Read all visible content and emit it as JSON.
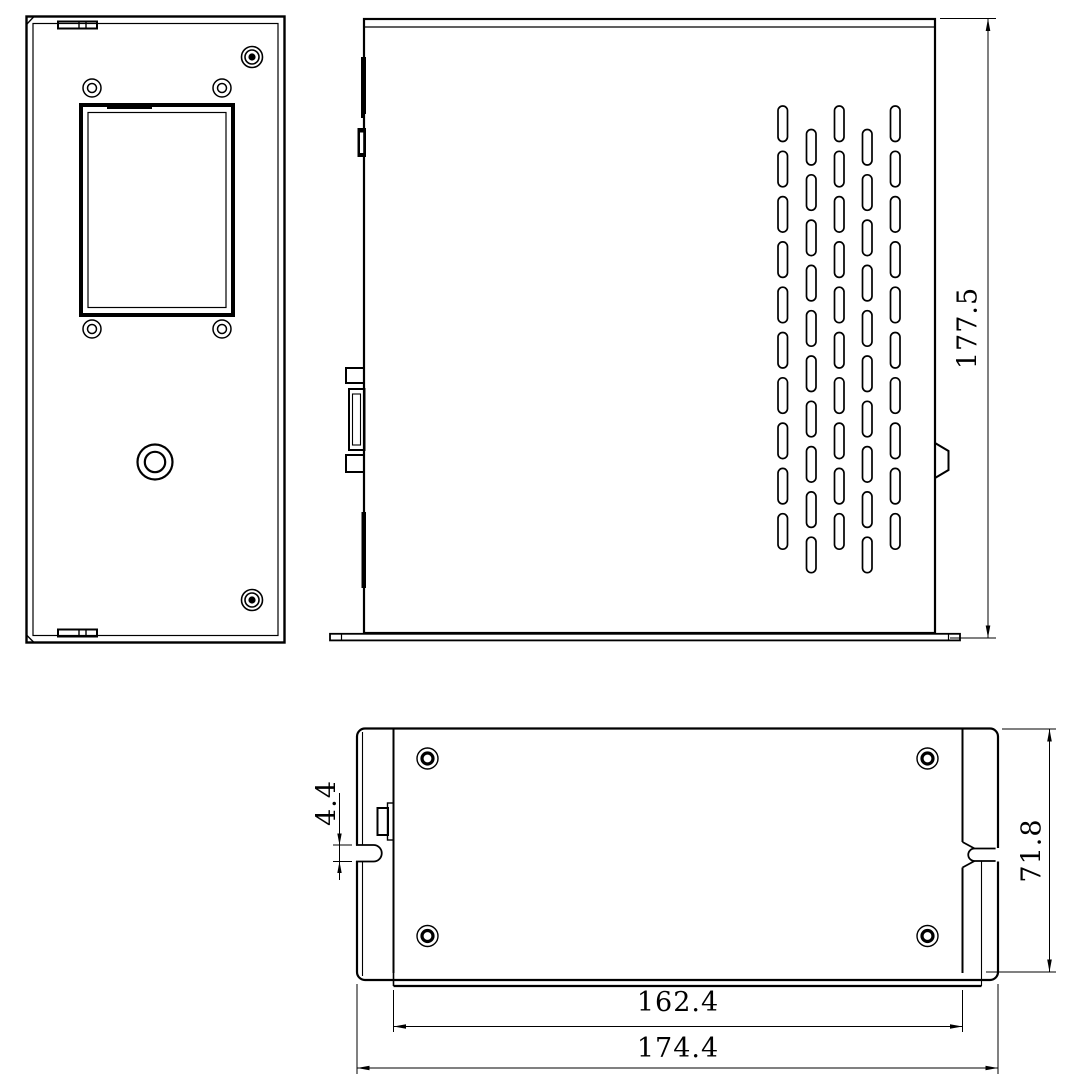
{
  "drawing": {
    "background": "#ffffff",
    "line_color": "#000000",
    "dimensions": {
      "side_height": "177.5",
      "slot_width": "4.4",
      "depth": "71.8",
      "body_width": "162.4",
      "overall_width": "174.4"
    }
  }
}
